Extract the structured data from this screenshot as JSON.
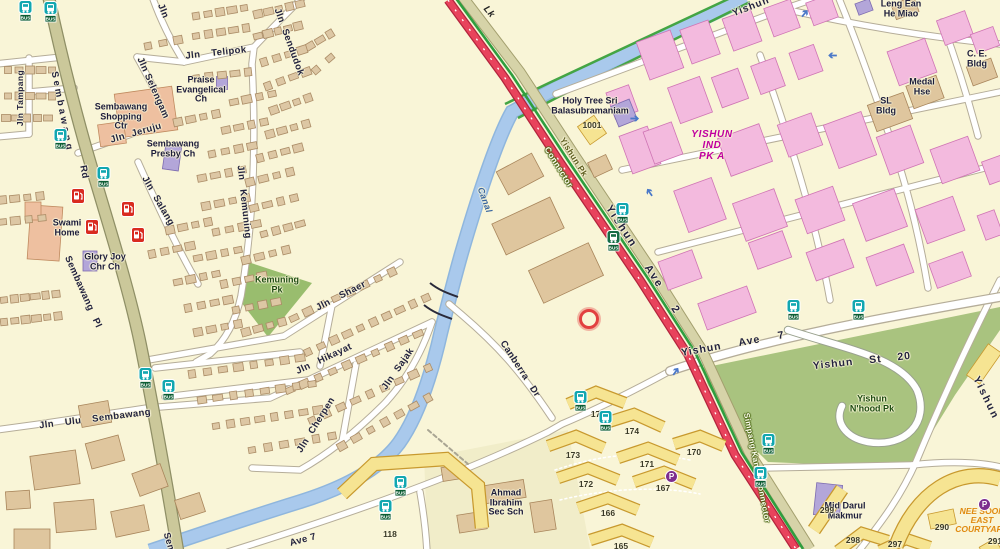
{
  "map_title": "Sembawang / Yishun street directory extract",
  "colors": {
    "background": "#f9f5d7",
    "major_road_red": "#e8435c",
    "khaki_road": "#cbc89a",
    "park_green": "#a9c37f",
    "canal_blue": "#a9c9ec",
    "hdb_yellow": "#f6e492",
    "industrial_pink": "#f3bade",
    "civic_purple": "#b3a6d9",
    "building_tan": "#dfc69e",
    "bus_teal": "#12a7b0",
    "bus_tag_green": "#0b5c33",
    "petrol_red": "#d92b20",
    "magenta_text": "#c000a0",
    "orange_text": "#e08a10"
  },
  "labels": {
    "roads": [
      {
        "text": "Sembawang",
        "x": 62,
        "y": 112,
        "rot": 79,
        "ls": 3
      },
      {
        "text": "Rd",
        "x": 84,
        "y": 172,
        "rot": 79
      },
      {
        "text": "Jln Tampang",
        "x": 20,
        "y": 98,
        "rot": -90,
        "fs": 8.5
      },
      {
        "text": "Jln Ulu Sembawang",
        "x": 95,
        "y": 419,
        "rot": -7,
        "ws": 8
      },
      {
        "text": "Sembawang Pl",
        "x": 83,
        "y": 292,
        "rot": 66,
        "ws": 6
      },
      {
        "text": "Jln Salang",
        "x": 158,
        "y": 201,
        "rot": 60,
        "ws": 4
      },
      {
        "text": "Jln Kemuning",
        "x": 244,
        "y": 202,
        "rot": 84,
        "ws": 6
      },
      {
        "text": "Jln Sendudok",
        "x": 289,
        "y": 42,
        "rot": 70,
        "ws": 4
      },
      {
        "text": "Jln Telipok",
        "x": 216,
        "y": 53,
        "rot": -6,
        "ws": 8
      },
      {
        "text": "Jln Selengam",
        "x": 153,
        "y": 88,
        "rot": 66
      },
      {
        "text": "Jln Jeruju",
        "x": 136,
        "y": 133,
        "rot": -16,
        "ws": 4
      },
      {
        "text": "Jln Shaer",
        "x": 341,
        "y": 296,
        "rot": -27,
        "ws": 8
      },
      {
        "text": "Jln Hikayat",
        "x": 324,
        "y": 359,
        "rot": -25,
        "ws": 6
      },
      {
        "text": "Jln Sajak",
        "x": 398,
        "y": 369,
        "rot": -55,
        "ws": 4
      },
      {
        "text": "Jln Cherpen",
        "x": 316,
        "y": 425,
        "rot": -58,
        "ws": 4
      },
      {
        "text": "Jln",
        "x": 163,
        "y": 11,
        "rot": 68
      },
      {
        "text": "Canberra Dr",
        "x": 520,
        "y": 369,
        "rot": 57,
        "ws": 6
      },
      {
        "text": "Ave 7",
        "x": 303,
        "y": 540,
        "rot": -15
      },
      {
        "text": "Sem",
        "x": 169,
        "y": 543,
        "rot": 74
      },
      {
        "text": "Yishun Ave 2",
        "x": 643,
        "y": 260,
        "rot": 57,
        "fs": 11,
        "ws": 18,
        "ls": 2
      },
      {
        "text": "Yishun Ave 7",
        "x": 733,
        "y": 344,
        "rot": -10,
        "fs": 10.5,
        "ws": 14,
        "ls": 1
      },
      {
        "text": "Yishun St 20",
        "x": 862,
        "y": 361,
        "rot": -6,
        "fs": 10.5,
        "ws": 12,
        "ls": 1
      },
      {
        "text": "Yishun",
        "x": 986,
        "y": 398,
        "rot": 64,
        "fs": 10.5,
        "ls": 2
      },
      {
        "text": "Yishun",
        "x": 751,
        "y": 7,
        "rot": -21,
        "fs": 10,
        "ls": 1
      }
    ],
    "specials": [
      {
        "text": "Lk",
        "cls": "lk",
        "x": 489,
        "y": 12,
        "rot": 50
      },
      {
        "text": "Canal",
        "cls": "canal",
        "x": 485,
        "y": 200,
        "rot": 70
      },
      {
        "text": "Yishun Pk",
        "cls": "pcn",
        "x": 574,
        "y": 157,
        "rot": 58
      },
      {
        "text": "Connector",
        "cls": "connwhite",
        "x": 559,
        "y": 167,
        "rot": 58
      },
      {
        "text": "Simpang Kanan Connector",
        "cls": "connwhite",
        "x": 757,
        "y": 468,
        "rot": 79,
        "fs": 8
      }
    ],
    "places": [
      {
        "lines": [
          "Sembawang",
          "Shopping",
          "Ctr"
        ],
        "x": 121,
        "y": 117
      },
      {
        "lines": [
          "Sembawang",
          "Presby Ch"
        ],
        "x": 173,
        "y": 149
      },
      {
        "lines": [
          "Praise",
          "Evangelical",
          "Ch"
        ],
        "x": 201,
        "y": 90
      },
      {
        "lines": [
          "Swami",
          "Home"
        ],
        "x": 67,
        "y": 228
      },
      {
        "lines": [
          "Glory Joy",
          "Chr Ch"
        ],
        "x": 105,
        "y": 262
      },
      {
        "lines": [
          "Kemuning",
          "Pk"
        ],
        "cls": "park",
        "x": 277,
        "y": 285
      },
      {
        "lines": [
          "Holy Tree Sri",
          "Balasubramaniam"
        ],
        "x": 590,
        "y": 106
      },
      {
        "lines": [
          "YISHUN",
          "IND",
          "PK A"
        ],
        "cls": "magenta",
        "x": 712,
        "y": 146
      },
      {
        "lines": [
          "Leng Ean",
          "He Miao"
        ],
        "x": 901,
        "y": 9
      },
      {
        "lines": [
          "C. E.",
          "Bldg"
        ],
        "x": 977,
        "y": 59
      },
      {
        "lines": [
          "Medal",
          "Hse"
        ],
        "x": 922,
        "y": 87
      },
      {
        "lines": [
          "SL",
          "Bldg"
        ],
        "x": 886,
        "y": 106
      },
      {
        "lines": [
          "Yishun",
          "N'hood Pk"
        ],
        "cls": "park",
        "x": 872,
        "y": 404
      },
      {
        "lines": [
          "Mjd Darul",
          "Makmur"
        ],
        "x": 845,
        "y": 511
      },
      {
        "lines": [
          "Ahmad",
          "Ibrahim",
          "Sec Sch"
        ],
        "x": 506,
        "y": 503
      },
      {
        "lines": [
          "NEE SOON",
          "EAST",
          "COURTYARD"
        ],
        "cls": "orange",
        "x": 982,
        "y": 521
      }
    ],
    "numbers": [
      {
        "text": "1001",
        "x": 592,
        "y": 125
      },
      {
        "text": "118",
        "x": 390,
        "y": 534
      },
      {
        "text": "175",
        "x": 598,
        "y": 414
      },
      {
        "text": "174",
        "x": 632,
        "y": 431
      },
      {
        "text": "173",
        "x": 573,
        "y": 455
      },
      {
        "text": "172",
        "x": 586,
        "y": 484
      },
      {
        "text": "171",
        "x": 647,
        "y": 464
      },
      {
        "text": "170",
        "x": 694,
        "y": 452
      },
      {
        "text": "167",
        "x": 663,
        "y": 488
      },
      {
        "text": "166",
        "x": 608,
        "y": 513
      },
      {
        "text": "165",
        "x": 621,
        "y": 546
      },
      {
        "text": "299",
        "x": 827,
        "y": 510
      },
      {
        "text": "298",
        "x": 853,
        "y": 540
      },
      {
        "text": "297",
        "x": 895,
        "y": 544
      },
      {
        "text": "290",
        "x": 942,
        "y": 527
      },
      {
        "text": "291",
        "x": 995,
        "y": 541
      }
    ]
  },
  "icons": {
    "bus_tag_text": "BUS",
    "parking_letter": "P",
    "bus_stops": [
      {
        "x": 25,
        "y": 8
      },
      {
        "x": 50,
        "y": 9
      },
      {
        "x": 60,
        "y": 136
      },
      {
        "x": 103,
        "y": 174
      },
      {
        "x": 145,
        "y": 375
      },
      {
        "x": 168,
        "y": 387
      },
      {
        "x": 622,
        "y": 210
      },
      {
        "x": 613,
        "y": 238,
        "variant": "dark"
      },
      {
        "x": 793,
        "y": 307
      },
      {
        "x": 858,
        "y": 307
      },
      {
        "x": 768,
        "y": 441
      },
      {
        "x": 760,
        "y": 474
      },
      {
        "x": 580,
        "y": 398
      },
      {
        "x": 605,
        "y": 418
      },
      {
        "x": 400,
        "y": 483
      },
      {
        "x": 385,
        "y": 507
      }
    ],
    "petrol_stations": [
      {
        "x": 78,
        "y": 196
      },
      {
        "x": 92,
        "y": 227
      },
      {
        "x": 128,
        "y": 209
      },
      {
        "x": 138,
        "y": 235
      }
    ],
    "parking": [
      {
        "x": 671,
        "y": 476
      },
      {
        "x": 984,
        "y": 504
      }
    ],
    "one_way_arrows": [
      {
        "x": 806,
        "y": 15,
        "rot": 40
      },
      {
        "x": 834,
        "y": 57,
        "rot": 270
      },
      {
        "x": 651,
        "y": 194,
        "rot": -35
      },
      {
        "x": 636,
        "y": 120,
        "rot": 90
      },
      {
        "x": 677,
        "y": 373,
        "rot": 35
      }
    ],
    "poi_ring": {
      "x": 588,
      "y": 318
    }
  }
}
